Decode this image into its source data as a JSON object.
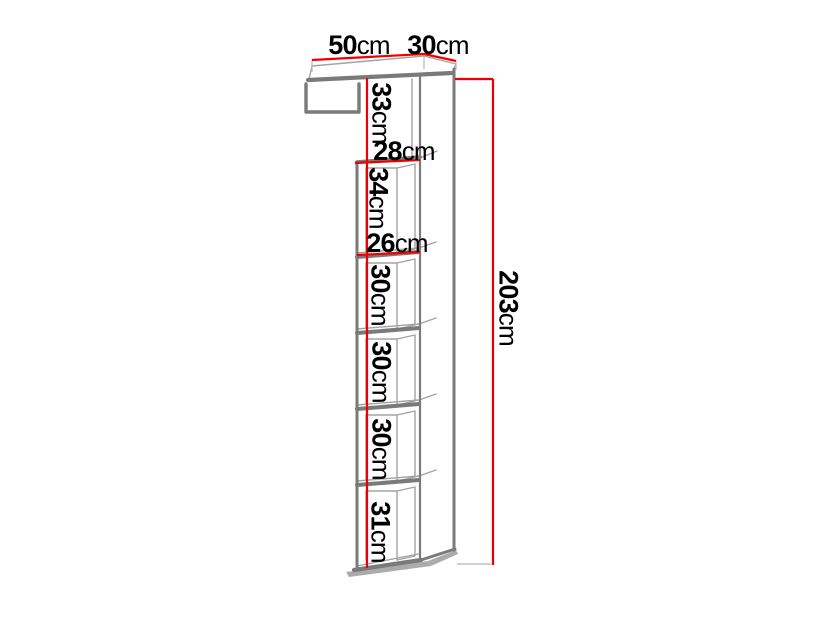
{
  "colors": {
    "background": "#ffffff",
    "dimension": "#ee0000",
    "outline": "#7a7a7a",
    "outline_light": "#a3a3a3",
    "extension": "#b5b5b5",
    "shadow": "#ababab",
    "text": "#000000"
  },
  "dimensions": [
    {
      "id": "top-width",
      "value": "50",
      "unit": "cm",
      "orientation": "horizontal"
    },
    {
      "id": "top-depth",
      "value": "30",
      "unit": "cm",
      "orientation": "horizontal"
    },
    {
      "id": "top-offset-height",
      "value": "33",
      "unit": "cm",
      "orientation": "vertical"
    },
    {
      "id": "outer-width",
      "value": "28",
      "unit": "cm",
      "orientation": "horizontal"
    },
    {
      "id": "compartment-1-height",
      "value": "34",
      "unit": "cm",
      "orientation": "vertical"
    },
    {
      "id": "inner-width",
      "value": "26",
      "unit": "cm",
      "orientation": "horizontal"
    },
    {
      "id": "compartment-2-height",
      "value": "30",
      "unit": "cm",
      "orientation": "vertical"
    },
    {
      "id": "compartment-3-height",
      "value": "30",
      "unit": "cm",
      "orientation": "vertical"
    },
    {
      "id": "compartment-4-height",
      "value": "30",
      "unit": "cm",
      "orientation": "vertical"
    },
    {
      "id": "compartment-5-height",
      "value": "31",
      "unit": "cm",
      "orientation": "vertical"
    },
    {
      "id": "total-height",
      "value": "203",
      "unit": "cm",
      "orientation": "vertical"
    }
  ]
}
